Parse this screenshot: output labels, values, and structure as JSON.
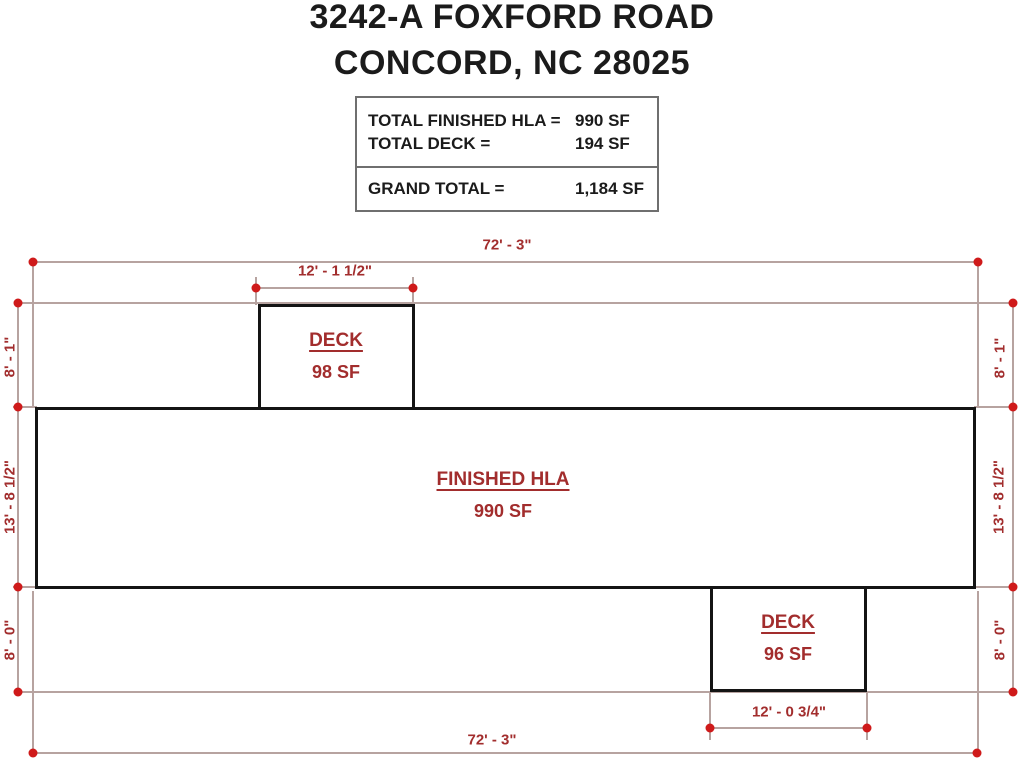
{
  "title": {
    "line1": "3242-A FOXFORD ROAD",
    "line2": "CONCORD, NC 28025"
  },
  "summary": {
    "rows": [
      {
        "label": "TOTAL FINISHED HLA =",
        "value": "990 SF"
      },
      {
        "label": "TOTAL DECK =",
        "value": "194 SF"
      },
      {
        "label": "GRAND TOTAL =",
        "value": "1,184 SF"
      }
    ]
  },
  "plan": {
    "areas": [
      {
        "name": "DECK",
        "sf": "98 SF"
      },
      {
        "name": "FINISHED HLA",
        "sf": "990 SF"
      },
      {
        "name": "DECK",
        "sf": "96 SF"
      }
    ],
    "dimensions": {
      "top_width": "72' - 3\"",
      "bottom_width": "72' - 3\"",
      "top_deck_width": "12' - 1 1/2\"",
      "bottom_deck_width": "12' - 0 3/4\"",
      "left_top": "8' - 1\"",
      "left_middle": "13' - 8 1/2\"",
      "left_bottom": "8' - 0\"",
      "right_top": "8' - 1\"",
      "right_middle": "13' - 8 1/2\"",
      "right_bottom": "8' - 0\""
    }
  },
  "colors": {
    "dimension_text": "#a22d2d",
    "dimension_dot": "#cf1a1a",
    "dimension_line": "#b7a3a0",
    "outline": "#141414"
  }
}
